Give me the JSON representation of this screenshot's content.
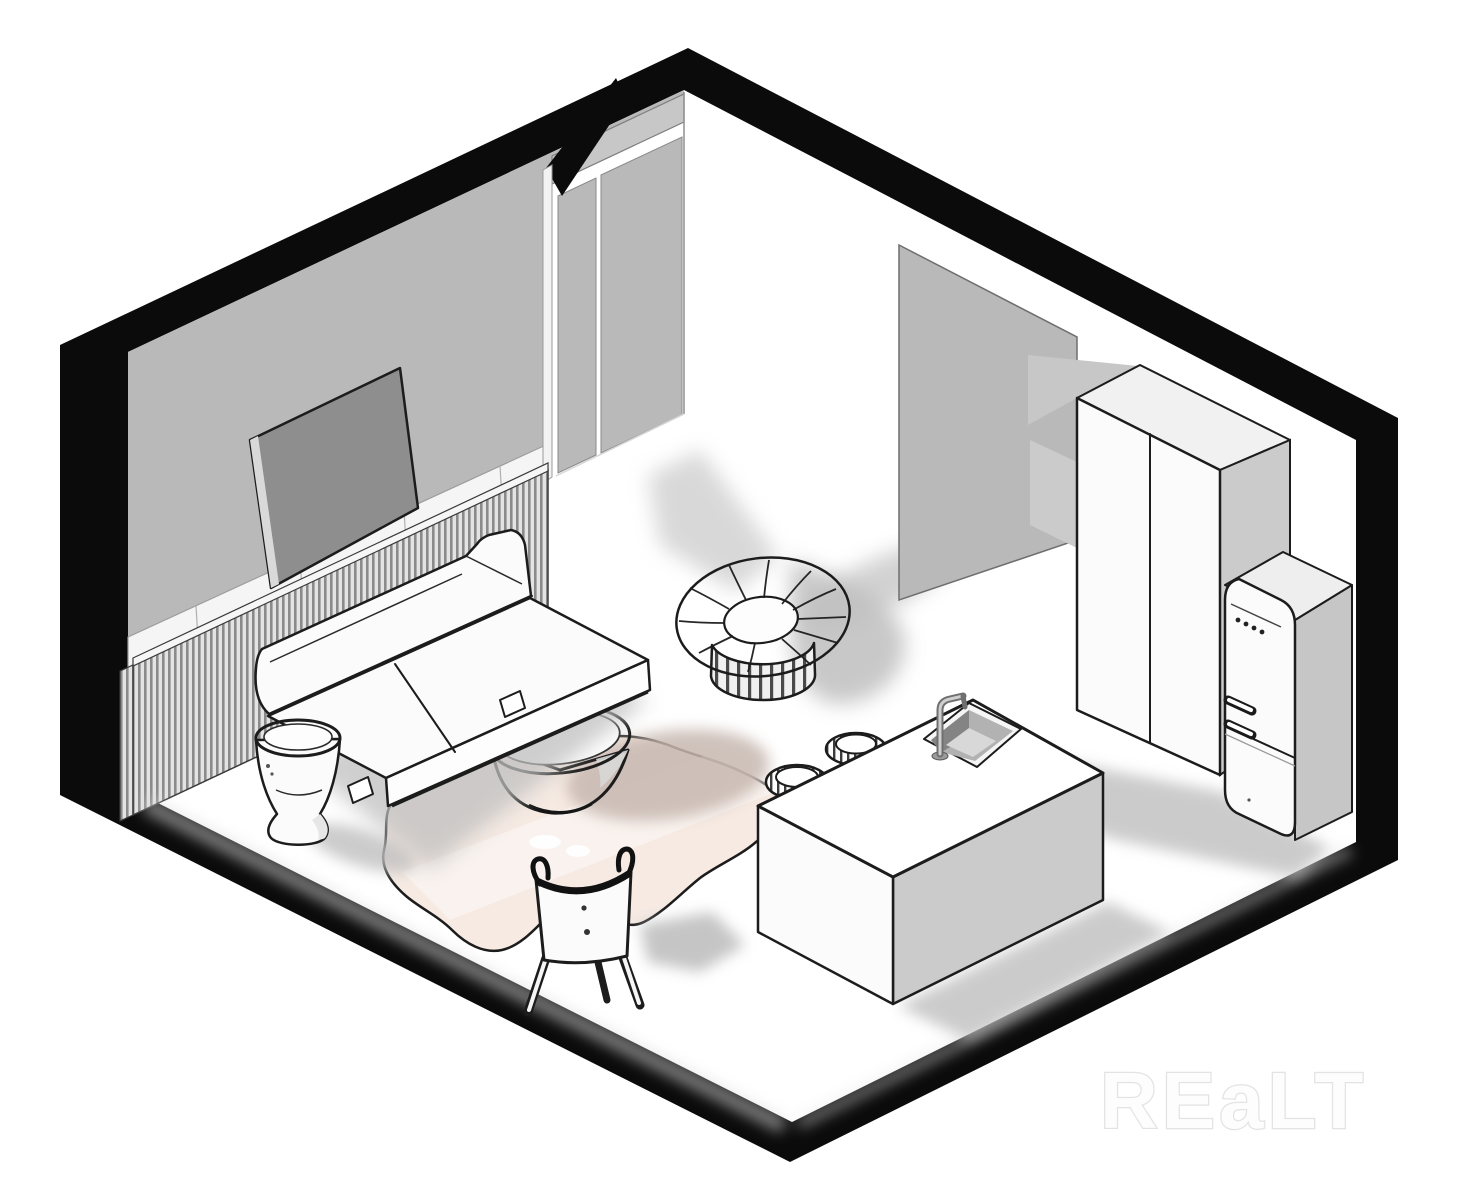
{
  "scene": {
    "type": "isometric-room-cutaway-floorplan",
    "watermark": "REaLT",
    "colors": {
      "outline": "#0b0b0b",
      "ink": "#1c1c1c",
      "wall": "#b9b9b9",
      "wall_mid": "#c7c7c7",
      "plinth": "#f5f5f5",
      "floor": "#ffffff",
      "white": "#fbfbfb",
      "white_shade": "#ededed",
      "side": "#cbcbcb",
      "tv": "#8e8e8e",
      "tv_edge": "#d9d9d9",
      "rug": "#f6eae3",
      "rug_shadow": "#c7b8b0",
      "shadow": "#bfbfbf",
      "shadow_dark": "#a9a9a9",
      "chrome": "#9b9b9b",
      "watermark_fill": "#fdfdfd",
      "watermark_stroke": "#e3e3e3"
    },
    "objects": [
      {
        "name": "room-shell",
        "label": "Room wall section outline"
      },
      {
        "name": "doorway",
        "label": "Doorway opening"
      },
      {
        "name": "tv",
        "label": "Wall-mounted TV"
      },
      {
        "name": "radiator",
        "label": "Slatted radiator panel"
      },
      {
        "name": "sofa",
        "label": "Sofa"
      },
      {
        "name": "vase-table",
        "label": "Vase side table"
      },
      {
        "name": "bowl-table",
        "label": "Bowl coffee table"
      },
      {
        "name": "rug",
        "label": "Cowhide rug"
      },
      {
        "name": "chair",
        "label": "Chair"
      },
      {
        "name": "pouf",
        "label": "Round tufted lounge chair"
      },
      {
        "name": "kitchen-island",
        "label": "Kitchen island with sink"
      },
      {
        "name": "bar-stools",
        "label": "Bar stools"
      },
      {
        "name": "wardrobe",
        "label": "Tall wardrobe cabinet"
      },
      {
        "name": "fridge",
        "label": "Retro refrigerator"
      },
      {
        "name": "partition",
        "label": "Partition wall"
      }
    ]
  }
}
